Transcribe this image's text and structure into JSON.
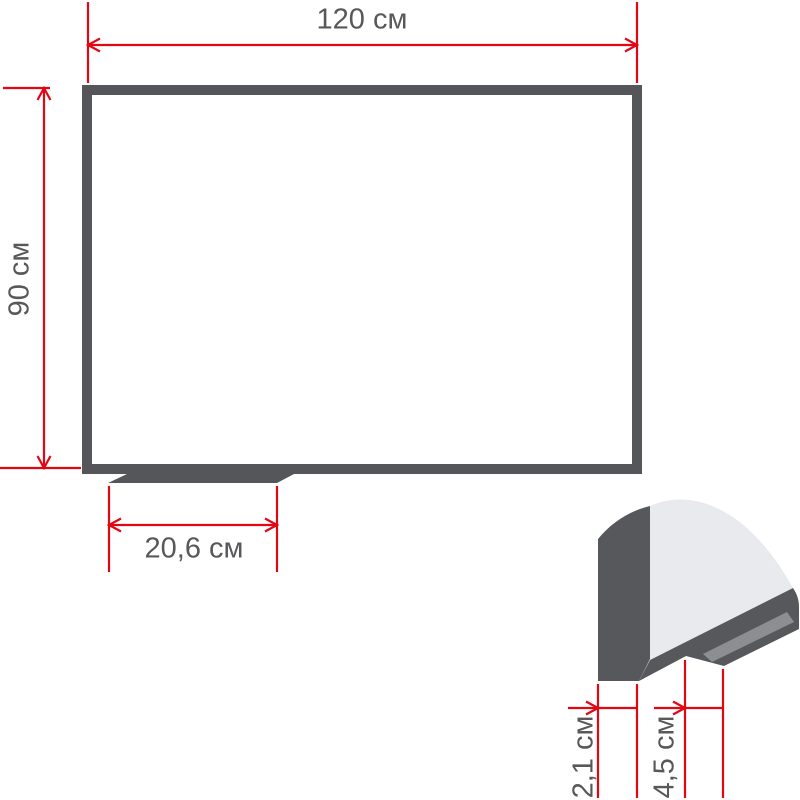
{
  "page": {
    "description": "Dimensional diagram of a magnetic whiteboard with marker tray and frame profile detail"
  },
  "colors": {
    "dimension_red": "#e30613",
    "frame_gray": "#545659",
    "profile_dark_gray": "#57585b",
    "profile_surface_light": "#e9eaee",
    "profile_tray_mid_gray": "#8c8e91",
    "label_text": "#58585a",
    "board_surface": "#ffffff",
    "page_background": "#ffffff"
  },
  "front_view": {
    "width_label": "120 см",
    "height_label": "90 см",
    "tray_width_label": "20,6 см"
  },
  "profile_detail": {
    "frame_depth_label": "2,1 см",
    "tray_depth_label": "4,5 см"
  }
}
